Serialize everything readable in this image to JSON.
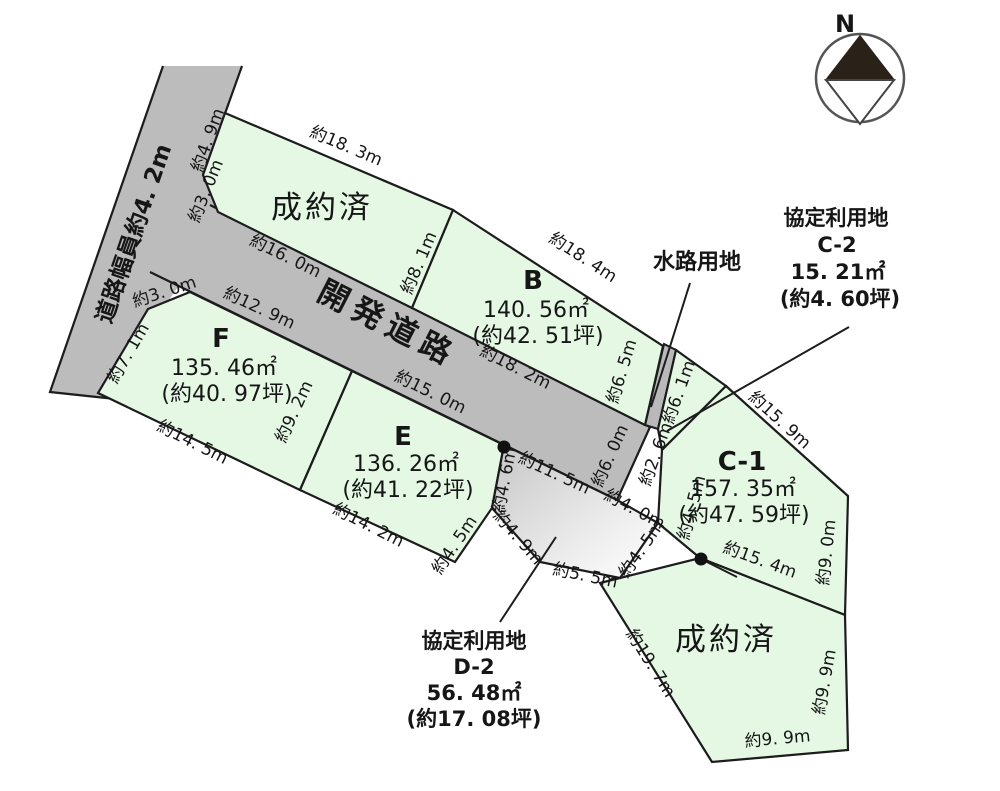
{
  "compass": {
    "n": "N"
  },
  "roads": {
    "left_label": "道路幅員約4. 2m",
    "dev_label": "開発道路"
  },
  "plots": {
    "sold_top": {
      "status": "成約済"
    },
    "b": {
      "name": "B",
      "area": "140. 56㎡",
      "tsubo": "(約42. 51坪)"
    },
    "f": {
      "name": "F",
      "area": "135. 46㎡",
      "tsubo": "(約40. 97坪)"
    },
    "e": {
      "name": "E",
      "area": "136. 26㎡",
      "tsubo": "(約41. 22坪)"
    },
    "c1": {
      "name": "C-1",
      "area": "157. 35㎡",
      "tsubo": "(約47. 59坪)"
    },
    "sold_bottom": {
      "status": "成約済"
    }
  },
  "annotations": {
    "waterway": {
      "title": "水路用地"
    },
    "c2": {
      "title": "協定利用地",
      "name": "C-2",
      "area": "15. 21㎡",
      "tsubo": "(約4. 60坪)"
    },
    "d2": {
      "title": "協定利用地",
      "name": "D-2",
      "area": "56. 48㎡",
      "tsubo": "(約17. 08坪)"
    }
  },
  "colors": {
    "plot_green": "#e4f8e4",
    "road_gray": "#bcbcbc",
    "line": "#1c1c1c"
  },
  "dims": [
    {
      "t": "約4. 9m"
    },
    {
      "t": "約3. 0m"
    },
    {
      "t": "約18. 3m"
    },
    {
      "t": "約16. 0m"
    },
    {
      "t": "約8. 1m"
    },
    {
      "t": "約18. 4m"
    },
    {
      "t": "約18. 2m"
    },
    {
      "t": "約6. 5m"
    },
    {
      "t": "約6. 1m"
    },
    {
      "t": "約2. 6m"
    },
    {
      "t": "約15. 9m"
    },
    {
      "t": "約9. 0m"
    },
    {
      "t": "約15. 4m"
    },
    {
      "t": "約4. 5m"
    },
    {
      "t": "約6. 0m"
    },
    {
      "t": "約4. 6m"
    },
    {
      "t": "約11. 5m"
    },
    {
      "t": "約4. 0m"
    },
    {
      "t": "約4. 5m"
    },
    {
      "t": "約5. 5m"
    },
    {
      "t": "約4. 9m"
    },
    {
      "t": "約4. 5m"
    },
    {
      "t": "約14. 2m"
    },
    {
      "t": "約15. 0m"
    },
    {
      "t": "約9. 2m"
    },
    {
      "t": "約12. 9m"
    },
    {
      "t": "約3. 0m"
    },
    {
      "t": "約7. 1m"
    },
    {
      "t": "約14. 5m"
    },
    {
      "t": "約19. 7m"
    },
    {
      "t": "約9. 9m"
    },
    {
      "t": "約9. 9m"
    }
  ]
}
